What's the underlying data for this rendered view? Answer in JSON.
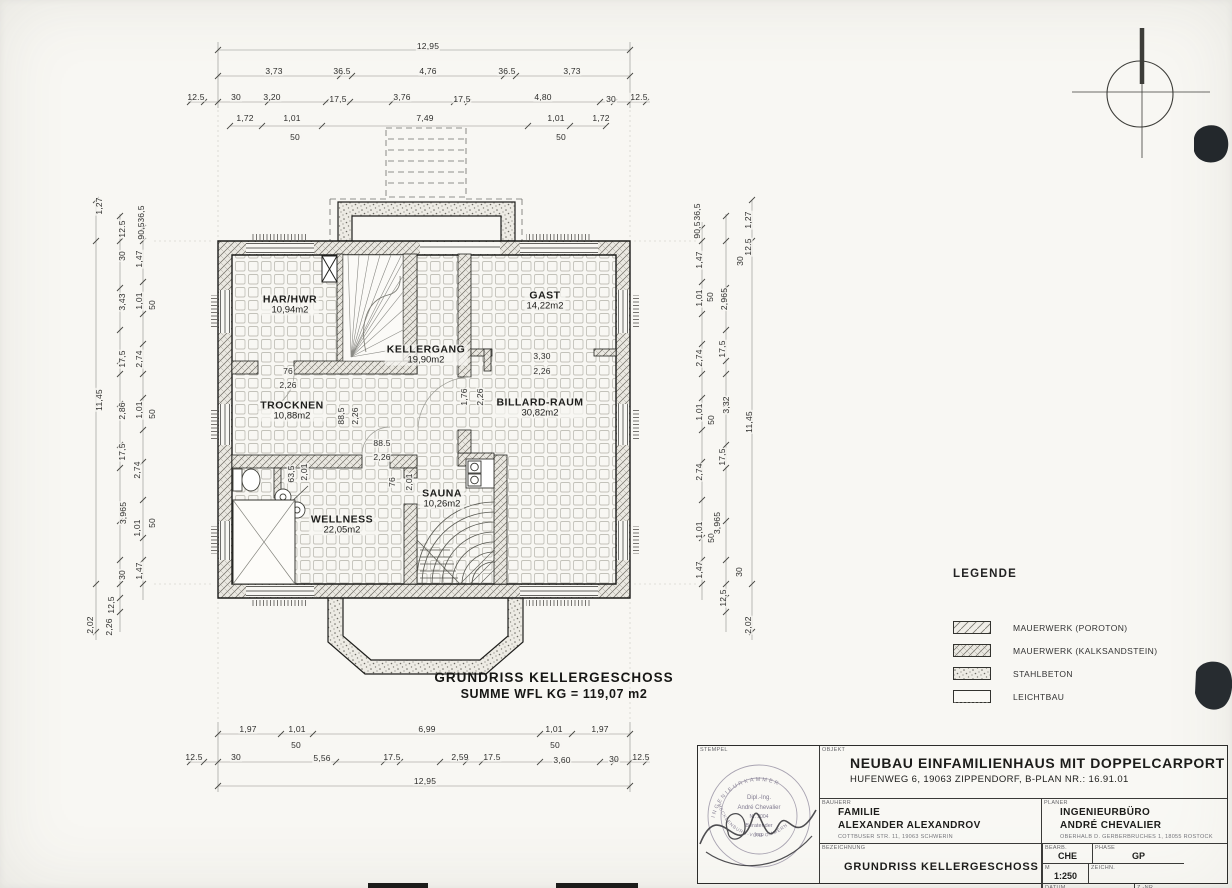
{
  "caption": {
    "line1": "GRUNDRISS KELLERGESCHOSS",
    "line2": "SUMME WFL KG = 119,07 m2"
  },
  "legend": {
    "title": "LEGENDE",
    "items": [
      {
        "label": "MAUERWERK  (POROTON)",
        "pattern": "diagonal-hatch"
      },
      {
        "label": "MAUERWERK  (KALKSANDSTEIN)",
        "pattern": "cross-hatch"
      },
      {
        "label": "STAHLBETON",
        "pattern": "stipple"
      },
      {
        "label": "LEICHTBAU",
        "pattern": "plain"
      }
    ]
  },
  "rooms": [
    {
      "n": "HAR/HWR",
      "a": "10,94m2",
      "x": 290,
      "y": 297
    },
    {
      "n": "KELLERGANG",
      "a": "19,90m2",
      "x": 426,
      "y": 347
    },
    {
      "n": "GAST",
      "a": "14,22m2",
      "x": 545,
      "y": 293
    },
    {
      "n": "TROCKNEN",
      "a": "10,88m2",
      "x": 292,
      "y": 403
    },
    {
      "n": "BILLARD-RAUM",
      "a": "30,82m2",
      "x": 540,
      "y": 400
    },
    {
      "n": "WELLNESS",
      "a": "22,05m2",
      "x": 342,
      "y": 517
    },
    {
      "n": "SAUNA",
      "a": "10,26m2",
      "x": 442,
      "y": 491
    }
  ],
  "dims": [
    {
      "t": "12,95",
      "x": 428,
      "y": 46
    },
    {
      "t": "3,73",
      "x": 274,
      "y": 71
    },
    {
      "t": "36.5",
      "x": 342,
      "y": 71
    },
    {
      "t": "4,76",
      "x": 428,
      "y": 71
    },
    {
      "t": "36.5",
      "x": 507,
      "y": 71
    },
    {
      "t": "3,73",
      "x": 572,
      "y": 71
    },
    {
      "t": "12.5",
      "x": 196,
      "y": 97
    },
    {
      "t": "30",
      "x": 236,
      "y": 97
    },
    {
      "t": "3,20",
      "x": 272,
      "y": 97
    },
    {
      "t": "17,5",
      "x": 338,
      "y": 99
    },
    {
      "t": "3,76",
      "x": 402,
      "y": 97
    },
    {
      "t": "17,5",
      "x": 462,
      "y": 99
    },
    {
      "t": "4,80",
      "x": 543,
      "y": 97
    },
    {
      "t": "30",
      "x": 611,
      "y": 99
    },
    {
      "t": "12.5",
      "x": 639,
      "y": 97
    },
    {
      "t": "1,72",
      "x": 245,
      "y": 118
    },
    {
      "t": "1,01",
      "x": 292,
      "y": 118
    },
    {
      "t": "7,49",
      "x": 425,
      "y": 118
    },
    {
      "t": "1,01",
      "x": 556,
      "y": 118
    },
    {
      "t": "1,72",
      "x": 601,
      "y": 118
    },
    {
      "t": "50",
      "x": 295,
      "y": 137
    },
    {
      "t": "50",
      "x": 561,
      "y": 137
    },
    {
      "t": "1,97",
      "x": 248,
      "y": 729
    },
    {
      "t": "1,01",
      "x": 297,
      "y": 729
    },
    {
      "t": "6,99",
      "x": 427,
      "y": 729
    },
    {
      "t": "1,01",
      "x": 554,
      "y": 729
    },
    {
      "t": "1,97",
      "x": 600,
      "y": 729
    },
    {
      "t": "50",
      "x": 296,
      "y": 745
    },
    {
      "t": "50",
      "x": 555,
      "y": 745
    },
    {
      "t": "12.5",
      "x": 194,
      "y": 757
    },
    {
      "t": "30",
      "x": 236,
      "y": 757
    },
    {
      "t": "5,56",
      "x": 322,
      "y": 758
    },
    {
      "t": "17.5",
      "x": 392,
      "y": 757
    },
    {
      "t": "2,59",
      "x": 460,
      "y": 757
    },
    {
      "t": "17.5",
      "x": 492,
      "y": 757
    },
    {
      "t": "3,60",
      "x": 562,
      "y": 760
    },
    {
      "t": "30",
      "x": 614,
      "y": 759
    },
    {
      "t": "12.5",
      "x": 641,
      "y": 757
    },
    {
      "t": "12,95",
      "x": 425,
      "y": 781
    },
    {
      "t": "1,27",
      "x": 99,
      "y": 206,
      "r": 1
    },
    {
      "t": "11,45",
      "x": 99,
      "y": 400,
      "r": 1
    },
    {
      "t": "2,02",
      "x": 90,
      "y": 625,
      "r": 1
    },
    {
      "t": "12.5",
      "x": 122,
      "y": 229,
      "r": 1
    },
    {
      "t": "30",
      "x": 122,
      "y": 256,
      "r": 1
    },
    {
      "t": "3,43",
      "x": 122,
      "y": 302,
      "r": 1
    },
    {
      "t": "17,5",
      "x": 122,
      "y": 359,
      "r": 1
    },
    {
      "t": "2,86",
      "x": 122,
      "y": 411,
      "r": 1
    },
    {
      "t": "17,5",
      "x": 122,
      "y": 452,
      "r": 1
    },
    {
      "t": "3,965",
      "x": 123,
      "y": 513,
      "r": 1
    },
    {
      "t": "30",
      "x": 122,
      "y": 575,
      "r": 1
    },
    {
      "t": "12,5",
      "x": 111,
      "y": 605,
      "r": 1
    },
    {
      "t": "2,26",
      "x": 109,
      "y": 627,
      "r": 1
    },
    {
      "t": "36,5",
      "x": 141,
      "y": 214,
      "r": 1
    },
    {
      "t": "90,5",
      "x": 141,
      "y": 231,
      "r": 1
    },
    {
      "t": "1,47",
      "x": 139,
      "y": 259,
      "r": 1
    },
    {
      "t": "1,01",
      "x": 139,
      "y": 301,
      "r": 1
    },
    {
      "t": "50",
      "x": 152,
      "y": 305,
      "r": 1
    },
    {
      "t": "2,74",
      "x": 139,
      "y": 359,
      "r": 1
    },
    {
      "t": "1,01",
      "x": 139,
      "y": 410,
      "r": 1
    },
    {
      "t": "50",
      "x": 152,
      "y": 414,
      "r": 1
    },
    {
      "t": "2,74",
      "x": 137,
      "y": 470,
      "r": 1
    },
    {
      "t": "1,01",
      "x": 137,
      "y": 528,
      "r": 1
    },
    {
      "t": "50",
      "x": 152,
      "y": 523,
      "r": 1
    },
    {
      "t": "1,47",
      "x": 139,
      "y": 571,
      "r": 1
    },
    {
      "t": "36,5",
      "x": 697,
      "y": 212,
      "r": 1
    },
    {
      "t": "90,5",
      "x": 697,
      "y": 230,
      "r": 1
    },
    {
      "t": "1,47",
      "x": 699,
      "y": 260,
      "r": 1
    },
    {
      "t": "1,01",
      "x": 699,
      "y": 298,
      "r": 1
    },
    {
      "t": "50",
      "x": 710,
      "y": 297,
      "r": 1
    },
    {
      "t": "2,965",
      "x": 724,
      "y": 299,
      "r": 1
    },
    {
      "t": "17,5",
      "x": 722,
      "y": 349,
      "r": 1
    },
    {
      "t": "2,74",
      "x": 699,
      "y": 358,
      "r": 1
    },
    {
      "t": "1,01",
      "x": 699,
      "y": 412,
      "r": 1
    },
    {
      "t": "50",
      "x": 711,
      "y": 420,
      "r": 1
    },
    {
      "t": "3,32",
      "x": 726,
      "y": 405,
      "r": 1
    },
    {
      "t": "17,5",
      "x": 722,
      "y": 457,
      "r": 1
    },
    {
      "t": "2,74",
      "x": 699,
      "y": 472,
      "r": 1
    },
    {
      "t": "1,01",
      "x": 699,
      "y": 530,
      "r": 1
    },
    {
      "t": "50",
      "x": 711,
      "y": 538,
      "r": 1
    },
    {
      "t": "3,965",
      "x": 717,
      "y": 523,
      "r": 1
    },
    {
      "t": "1,47",
      "x": 699,
      "y": 570,
      "r": 1
    },
    {
      "t": "30",
      "x": 739,
      "y": 572,
      "r": 1
    },
    {
      "t": "12,5",
      "x": 723,
      "y": 598,
      "r": 1
    },
    {
      "t": "1,27",
      "x": 748,
      "y": 220,
      "r": 1
    },
    {
      "t": "12.5",
      "x": 748,
      "y": 247,
      "r": 1
    },
    {
      "t": "30",
      "x": 740,
      "y": 261,
      "r": 1
    },
    {
      "t": "11,45",
      "x": 749,
      "y": 422,
      "r": 1
    },
    {
      "t": "2,02",
      "x": 748,
      "y": 625,
      "r": 1
    },
    {
      "t": "76",
      "x": 288,
      "y": 371
    },
    {
      "t": "2,26",
      "x": 288,
      "y": 385
    },
    {
      "t": "88,5",
      "x": 341,
      "y": 416,
      "r": 1
    },
    {
      "t": "2,26",
      "x": 355,
      "y": 416,
      "r": 1
    },
    {
      "t": "88.5",
      "x": 382,
      "y": 443
    },
    {
      "t": "2,26",
      "x": 382,
      "y": 457
    },
    {
      "t": "1,76",
      "x": 464,
      "y": 397,
      "r": 1
    },
    {
      "t": "2,26",
      "x": 480,
      "y": 397,
      "r": 1
    },
    {
      "t": "3,30",
      "x": 542,
      "y": 356
    },
    {
      "t": "2,26",
      "x": 542,
      "y": 371
    },
    {
      "t": "63,5",
      "x": 291,
      "y": 474,
      "r": 1
    },
    {
      "t": "2,01",
      "x": 304,
      "y": 472,
      "r": 1
    },
    {
      "t": "76",
      "x": 392,
      "y": 482,
      "r": 1
    },
    {
      "t": "2,01",
      "x": 409,
      "y": 482,
      "r": 1
    }
  ],
  "titleblock": {
    "stempel_label": "STEMPEL",
    "objekt_label": "OBJEKT",
    "title": "NEUBAU EINFAMILIENHAUS MIT DOPPELCARPORT",
    "subtitle": "HUFENWEG 6, 19063 ZIPPENDORF, B-PLAN NR.: 16.91.01",
    "bauherr_label": "BAUHERR",
    "bauherr_line1": "FAMILIE",
    "bauherr_line2": "ALEXANDER ALEXANDROV",
    "bauherr_line3": "COTTBUSER STR. 11, 19063 SCHWERIN",
    "planer_label": "PLANER",
    "planer_line1": "INGENIEURBÜRO",
    "planer_line2": "ANDRÉ CHEVALIER",
    "planer_line3": "OBERHALB D. GERBERBRUCHES 1, 18055 ROSTOCK",
    "bezeichnung_label": "BEZEICHNUNG",
    "bezeichnung": "GRUNDRISS KELLERGESCHOSS",
    "bearb_label": "BEARB.",
    "bearb": "CHE",
    "phase_label": "PHASE",
    "phase": "GP",
    "m_label": "M",
    "m": "1:250",
    "zeichn_label": "ZEICHN.",
    "zeichn": "",
    "datum_label": "DATUM",
    "datum": "18.06.2007",
    "znr_label": "Z.-NR.",
    "znr": "A1.1"
  },
  "stamp": {
    "rim_top": "INGENIEURKAMMER",
    "rim_bottom": "MECKLENBURG-VORPOMMERN",
    "line1": "Dipl.-Ing.",
    "line2": "André Chevalier",
    "line3": "Nr. 2004",
    "line4": "Beratender",
    "line5": "Ing."
  },
  "colors": {
    "paper": "#f8f7f3",
    "ink": "#222220",
    "dimline": "#8b8b88",
    "blob": "#23282c"
  }
}
